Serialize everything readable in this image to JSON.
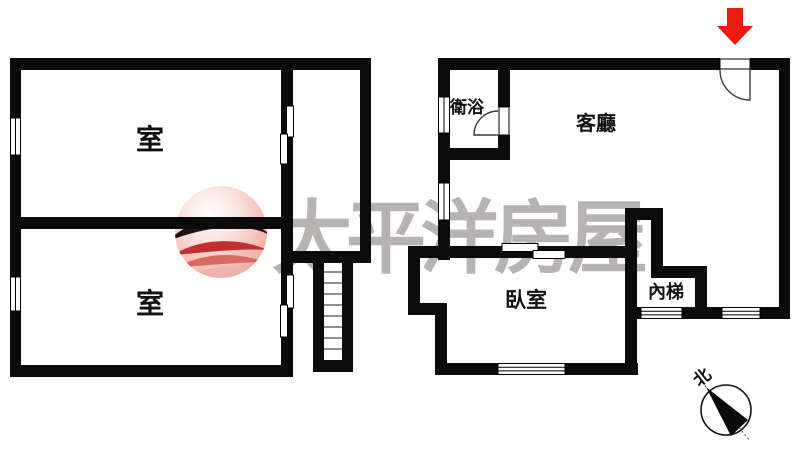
{
  "watermark": {
    "brand_text": "太平洋房屋"
  },
  "labels": {
    "left_room_top": "室",
    "left_room_bottom": "室",
    "bathroom": "衛浴",
    "living_room": "客廳",
    "bedroom": "臥室",
    "inner_stairs": "內梯",
    "compass_north": "北"
  },
  "colors": {
    "wall": "#0b0b0b",
    "label_text": "#111111",
    "door_line": "#3a3a3a",
    "tread_line": "#4a4a4a",
    "arrow_fill": "#ec1b10",
    "arrow_stroke": "#7a0b05",
    "watermark_text": "#b7b3b3",
    "logo_wave_dark": "#231111",
    "logo_wave_red": "#c22f2f",
    "logo_wave_mid": "#d96a5f",
    "logo_wave_light": "#eeb3aa"
  }
}
